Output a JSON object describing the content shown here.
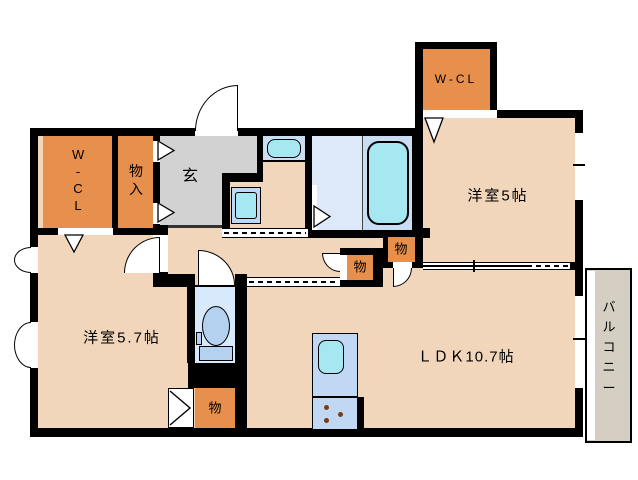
{
  "labels": {
    "wcl_top": "W-CL",
    "yoshitsu_5": "洋室5帖",
    "wcl_left": "W-CL",
    "monoiri": "物入",
    "genkan": "玄",
    "yoshitsu_57": "洋室5.7帖",
    "ldk": "ＬＤＫ10.7帖",
    "balcony": "バルコニー",
    "storage_hall_left": "物",
    "storage_hall_right": "物",
    "storage_bedroom": "物"
  },
  "colors": {
    "wall": "#000000",
    "floor": "#f1d6bc",
    "closet": "#e78f4c",
    "genkan": "#d2d2d2",
    "bath-floor": "#dde9f8",
    "tub-zone": "#c9def3",
    "fixture-cyan": "#a7e7f1",
    "fixture-blue": "#c1d8f5",
    "toilet-room": "#d7e9fb",
    "toilet-fixture": "#b4d2f0",
    "balcony-floor": "#d5cec2",
    "burner": "#7a3c10"
  }
}
